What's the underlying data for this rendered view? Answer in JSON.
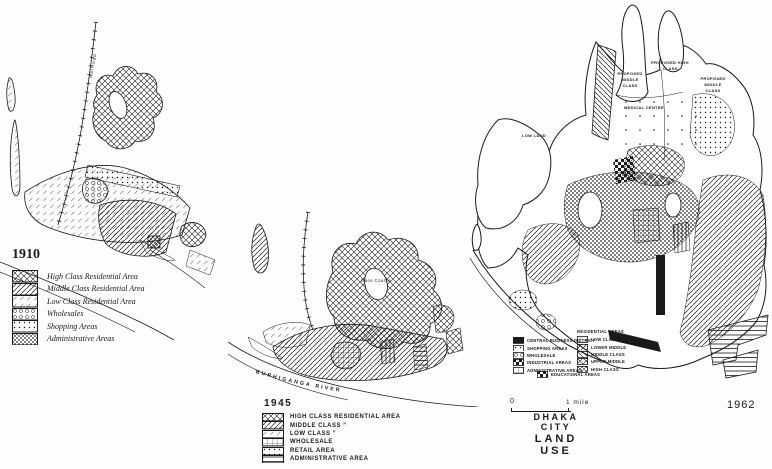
{
  "colors": {
    "ink": "#1a1a1a",
    "paper": "#fdfdfb"
  },
  "figure_title": {
    "line1": "DHAKA CITY",
    "line2": "LAND USE"
  },
  "scalebar": {
    "zero": "0",
    "mile": "1 mile"
  },
  "map1910": {
    "year": "1910",
    "labels": {
      "railroad": "Railroad"
    },
    "legend": [
      {
        "label": "High Class Residential Area",
        "pattern": "crosshatch"
      },
      {
        "label": "Middle Class Residential Area",
        "pattern": "diagonal"
      },
      {
        "label": "Low Class Residential Area",
        "pattern": "diaglight"
      },
      {
        "label": "Wholesales",
        "pattern": "circles"
      },
      {
        "label": "Shopping Areas",
        "pattern": "dots"
      },
      {
        "label": "Administrative Areas",
        "pattern": "dense"
      }
    ]
  },
  "map1945": {
    "year": "1945",
    "labels": {
      "race_course": "Race Course",
      "jail": "Jail",
      "river": "BURHIGANGA RIVER"
    },
    "legend": [
      {
        "label": "HIGH CLASS RESIDENTIAL AREA",
        "pattern": "crosshatch"
      },
      {
        "label": "MIDDLE CLASS ”",
        "pattern": "diagonal"
      },
      {
        "label": "LOW CLASS ”",
        "pattern": "diaglight"
      },
      {
        "label": "WHOLESALE",
        "pattern": "grid"
      },
      {
        "label": "RETAIL AREA",
        "pattern": "dots"
      },
      {
        "label": "ADMINISTRATIVE AREA",
        "pattern": "hlines"
      }
    ]
  },
  "map1962": {
    "year": "1962",
    "labels": {
      "proposed_high": "PROPOSED HIGH CLASS",
      "proposed_middle_left": "PROPOSED MIDDLE CLASS",
      "proposed_middle_right": "PROPOSED MIDDLE CLASS",
      "medical_centre": "MEDICAL CENTRE",
      "low_land": "LOW LAND"
    },
    "residential_header": "RESIDENTIAL AREAS",
    "legend_left": [
      {
        "label": "CENTRAL BUSINESS DISTRICT",
        "pattern": "black"
      },
      {
        "label": "SHOPPING AREAS",
        "pattern": "dots"
      },
      {
        "label": "WHOLESALE",
        "pattern": "circles"
      },
      {
        "label": "INDUSTRIAL AREAS",
        "pattern": "checker"
      },
      {
        "label": "ADMINISTRATIVE AREAS",
        "pattern": "grid"
      }
    ],
    "legend_right": [
      {
        "label": "LOW CLASS",
        "pattern": "diaglight"
      },
      {
        "label": "LOWER MIDDLE",
        "pattern": "diagonal"
      },
      {
        "label": "MIDDLE CLASS",
        "pattern": "backslash"
      },
      {
        "label": "UPPER MIDDLE",
        "pattern": "crosshatch"
      },
      {
        "label": "HIGH CLASS",
        "pattern": "dense"
      }
    ],
    "legend_bottom": [
      {
        "label": "EDUCATIONAL AREAS",
        "pattern": "checker"
      }
    ]
  }
}
